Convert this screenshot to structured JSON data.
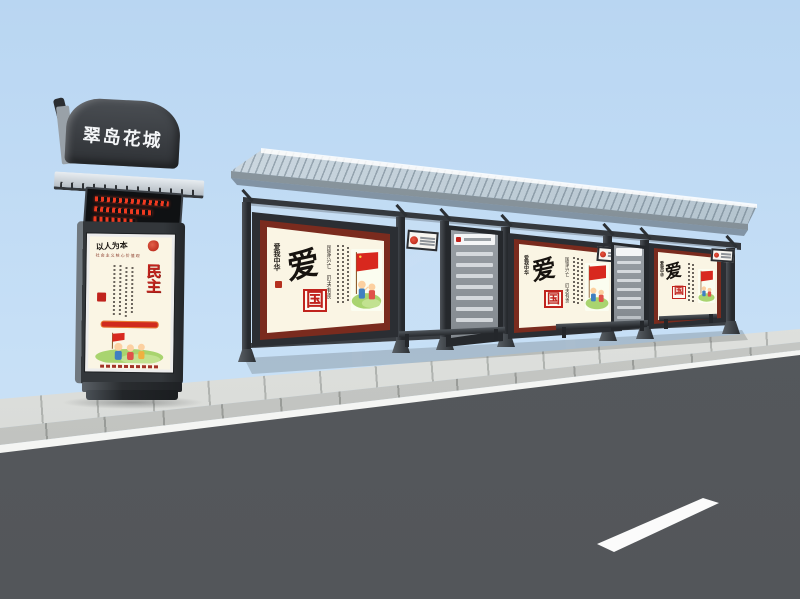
{
  "scene": {
    "description": "3D render of a roadside bus shelter with advertising light boxes, station name pylon, sidewalk and asphalt road",
    "canvas": {
      "width": 800,
      "height": 599
    }
  },
  "pylon": {
    "header_sign": "翠岛花城",
    "led_display": {
      "lines": 3,
      "color": "#f03a20"
    },
    "poster": {
      "title": "民主",
      "calligraphy": "以人为本",
      "series_subtitle": "社会主义核心价值观",
      "seal_color": "#c0231d"
    }
  },
  "shelter": {
    "posters": [
      {
        "calligraphy": "爱我中华",
        "char_main": "爱",
        "char_boxed": "国",
        "quote": "国家兴亡 匹夫有责"
      },
      {
        "calligraphy": "爱我中华",
        "char_main": "爱",
        "char_boxed": "国",
        "quote": "国家兴亡 匹夫有责"
      },
      {
        "calligraphy": "爱我中华",
        "char_main": "爱",
        "char_boxed": "国"
      }
    ],
    "route_boards": [
      {
        "rows": 7
      },
      {
        "rows": 6
      }
    ],
    "plaques": 3,
    "benches": 3
  },
  "colors": {
    "sky": "#c4def6",
    "road": "#56595d",
    "sidewalk": "#dcdedb",
    "gutter_line": "#f4f5f3",
    "lane_marking": "#fbfbfb",
    "shelter_frame": "#2b2e33",
    "roof": "#c6d3dc",
    "poster_background": "#faf5e4",
    "poster_frame": "#7a2b1e",
    "accent_red": "#c0231d",
    "led_red": "#f03a20"
  }
}
